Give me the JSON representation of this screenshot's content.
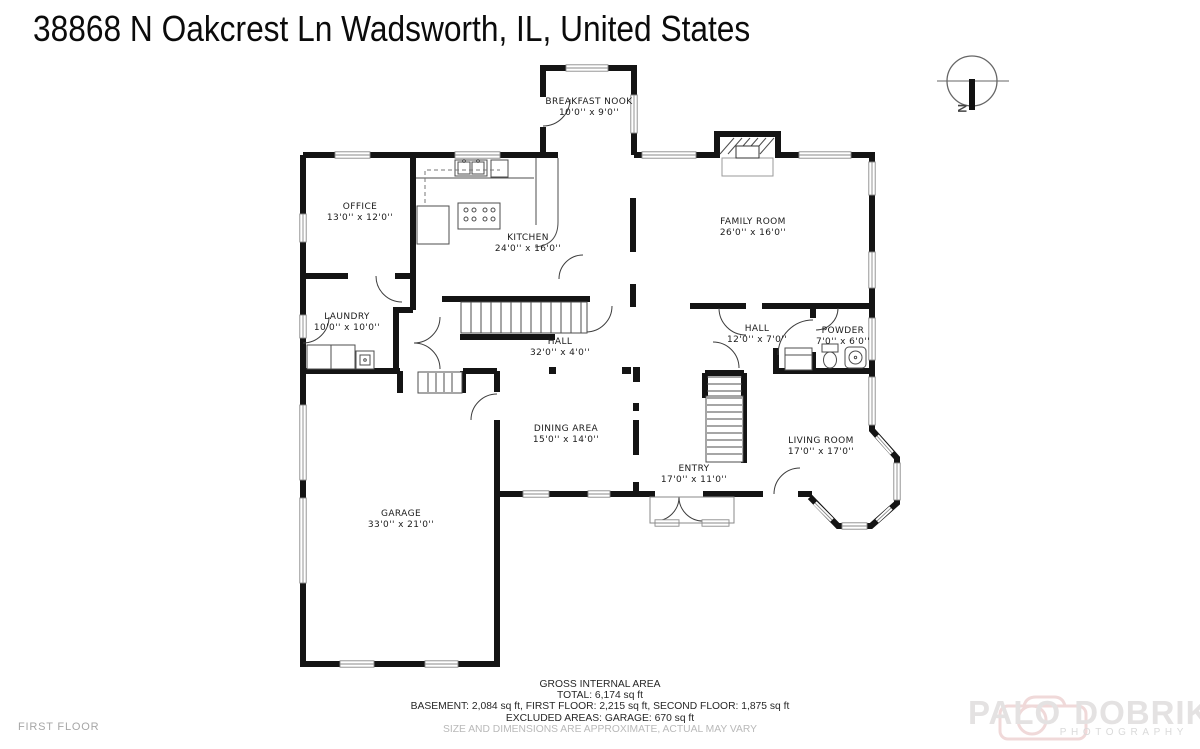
{
  "title": "38868 N Oakcrest Ln Wadsworth, IL, United States",
  "floor_label": "FIRST FLOOR",
  "compass": {
    "label": "N"
  },
  "rooms": [
    {
      "name": "BREAKFAST NOOK",
      "dims": "10'0'' x 9'0''"
    },
    {
      "name": "OFFICE",
      "dims": "13'0'' x 12'0''"
    },
    {
      "name": "KITCHEN",
      "dims": "24'0'' x 16'0''"
    },
    {
      "name": "FAMILY ROOM",
      "dims": "26'0'' x 16'0''"
    },
    {
      "name": "LAUNDRY",
      "dims": "10'0'' x 10'0''"
    },
    {
      "name": "HALL",
      "dims": "32'0'' x 4'0''"
    },
    {
      "name": "HALL",
      "dims": "12'0'' x 7'0''"
    },
    {
      "name": "POWDER",
      "dims": "7'0'' x 6'0''"
    },
    {
      "name": "DINING AREA",
      "dims": "15'0'' x 14'0''"
    },
    {
      "name": "ENTRY",
      "dims": "17'0'' x 11'0''"
    },
    {
      "name": "LIVING ROOM",
      "dims": "17'0'' x 17'0''"
    },
    {
      "name": "GARAGE",
      "dims": "33'0'' x 21'0''"
    }
  ],
  "area_summary": {
    "line1": "GROSS INTERNAL AREA",
    "line2": "TOTAL: 6,174 sq ft",
    "line3": "BASEMENT: 2,084 sq ft, FIRST FLOOR: 2,215 sq ft, SECOND FLOOR: 1,875 sq ft",
    "line4": "EXCLUDED AREAS: GARAGE: 670 sq ft",
    "line5": "SIZE AND DIMENSIONS ARE APPROXIMATE, ACTUAL MAY VARY"
  },
  "watermark": {
    "brand_left": "PALO",
    "brand_right": "DOBRIK",
    "subtitle": "PHOTOGRAPHY"
  },
  "colors": {
    "wall": "#141414",
    "window": "#8a8a8a",
    "watermark_pink": "#f0d9d9",
    "muted": "#b9b9b9"
  }
}
